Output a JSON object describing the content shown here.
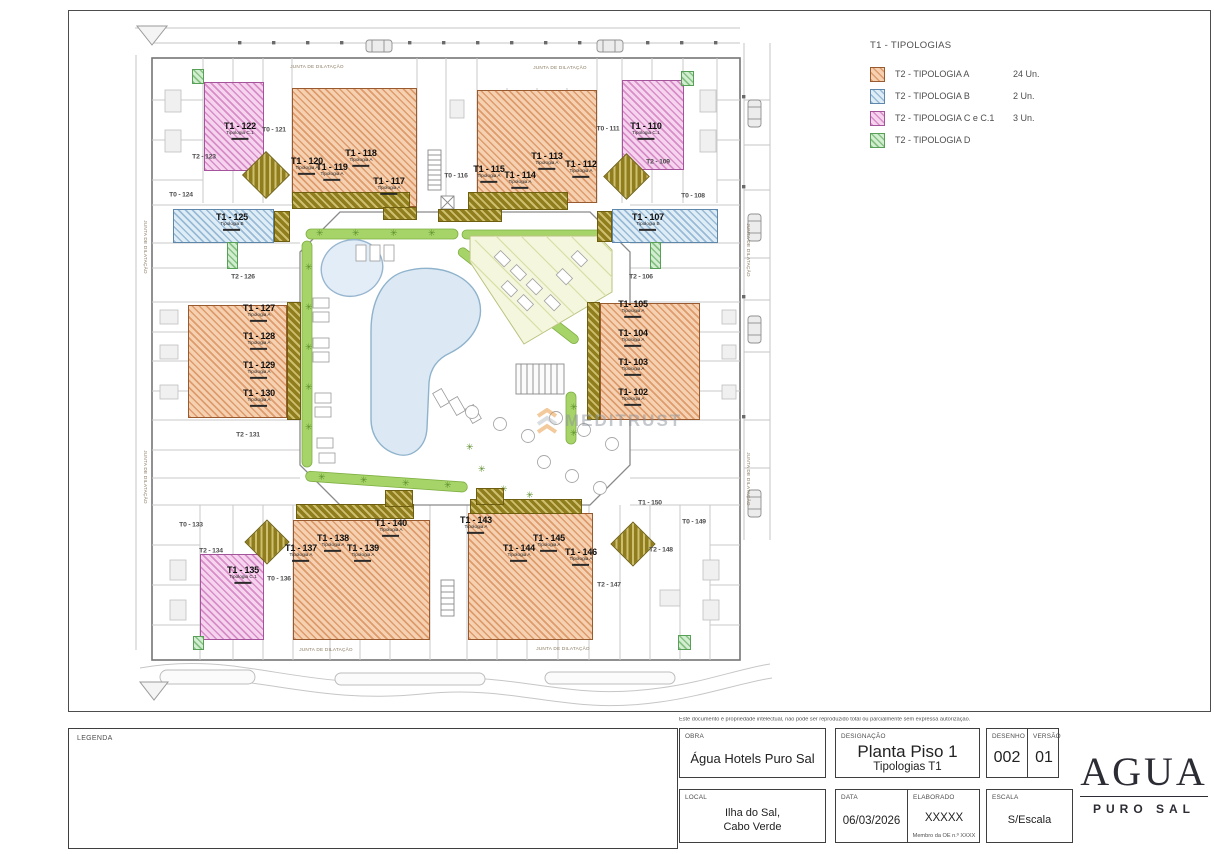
{
  "legend": {
    "title": "T1 - TIPOLOGIAS",
    "items": [
      {
        "label": "T2 - TIPOLOGIA A",
        "count": "24 Un.",
        "type": "a"
      },
      {
        "label": "T2 - TIPOLOGIA B",
        "count": "2 Un.",
        "type": "b"
      },
      {
        "label": "T2 - TIPOLOGIA C e C.1",
        "count": "3 Un.",
        "type": "c"
      },
      {
        "label": "T2 - TIPOLOGIA D",
        "count": "",
        "type": "d"
      }
    ]
  },
  "titleblock": {
    "disclaimer": "Este documento é propriedade intelectual, não pode ser reproduzido total ou parcialmente sem expressa autorização.",
    "legenda_label": "LEGENDA",
    "obra_label": "OBRA",
    "obra": "Água Hotels Puro Sal",
    "designacao_label": "DESIGNAÇÃO",
    "designacao": "Planta Piso 1",
    "designacao_sub": "Tipologias T1",
    "desenho_label": "DESENHO",
    "desenho": "002",
    "versao_label": "VERSÃO",
    "versao": "01",
    "local_label": "LOCAL",
    "local_line1": "Ilha do Sal,",
    "local_line2": "Cabo Verde",
    "data_label": "DATA",
    "data": "06/03/2026",
    "elaborado_label": "ELABORADO",
    "elaborado": "XXXXX",
    "elaborado_sub": "Membro da OE n.º XXXX",
    "escala_label": "ESCALA",
    "escala": "S/Escala"
  },
  "logo": {
    "name": "AGUA",
    "tagline": "PURO SAL"
  },
  "watermark": {
    "text": "MEDITRUST"
  },
  "plan": {
    "junta_label": "JUNTA DE DILATAÇÃO",
    "annotations": [
      {
        "x": 317,
        "y": 67,
        "v": false
      },
      {
        "x": 560,
        "y": 68,
        "v": false
      },
      {
        "x": 326,
        "y": 650,
        "v": false
      },
      {
        "x": 563,
        "y": 649,
        "v": false
      },
      {
        "x": 145,
        "y": 247,
        "v": true
      },
      {
        "x": 145,
        "y": 477,
        "v": true
      },
      {
        "x": 748,
        "y": 250,
        "v": true
      },
      {
        "x": 748,
        "y": 479,
        "v": true
      }
    ],
    "rooms": [
      {
        "label": "T1 - 122",
        "sub": "Tipologia C.1",
        "x": 240,
        "y": 131,
        "t": "c"
      },
      {
        "label": "T1 - 110",
        "sub": "Tipologia C.1",
        "x": 646,
        "y": 131,
        "t": "c"
      },
      {
        "label": "T1 - 135",
        "sub": "Tipologia C.1",
        "x": 243,
        "y": 575,
        "t": "c"
      },
      {
        "label": "T1 - 125",
        "sub": "Tipologia B",
        "x": 232,
        "y": 222,
        "t": "b"
      },
      {
        "label": "T1 - 107",
        "sub": "Tipologia B",
        "x": 648,
        "y": 222,
        "t": "b"
      },
      {
        "label": "T1 - 120",
        "sub": "Tipologia A",
        "x": 307,
        "y": 166,
        "t": "a"
      },
      {
        "label": "T1 - 119",
        "sub": "Tipologia A",
        "x": 332,
        "y": 172,
        "t": "a"
      },
      {
        "label": "T1 - 118",
        "sub": "Tipologia A",
        "x": 361,
        "y": 158,
        "t": "a"
      },
      {
        "label": "T1 - 117",
        "sub": "Tipologia A",
        "x": 389,
        "y": 186,
        "t": "a"
      },
      {
        "label": "T1 - 115",
        "sub": "Tipologia A",
        "x": 489,
        "y": 174,
        "t": "a"
      },
      {
        "label": "T1 - 114",
        "sub": "Tipologia A",
        "x": 520,
        "y": 180,
        "t": "a"
      },
      {
        "label": "T1 - 113",
        "sub": "Tipologia A",
        "x": 547,
        "y": 161,
        "t": "a"
      },
      {
        "label": "T1 - 112",
        "sub": "Tipologia A",
        "x": 581,
        "y": 169,
        "t": "a"
      },
      {
        "label": "T1 - 127",
        "sub": "Tipologia A",
        "x": 259,
        "y": 313,
        "t": "a"
      },
      {
        "label": "T1 - 128",
        "sub": "Tipologia A",
        "x": 259,
        "y": 341,
        "t": "a"
      },
      {
        "label": "T1 - 129",
        "sub": "Tipologia A",
        "x": 259,
        "y": 370,
        "t": "a"
      },
      {
        "label": "T1 - 130",
        "sub": "Tipologia A",
        "x": 259,
        "y": 398,
        "t": "a"
      },
      {
        "label": "T1- 105",
        "sub": "Tipologia A",
        "x": 633,
        "y": 309,
        "t": "a"
      },
      {
        "label": "T1- 104",
        "sub": "Tipologia A",
        "x": 633,
        "y": 338,
        "t": "a"
      },
      {
        "label": "T1- 103",
        "sub": "Tipologia A",
        "x": 633,
        "y": 367,
        "t": "a"
      },
      {
        "label": "T1- 102",
        "sub": "Tipologia A",
        "x": 633,
        "y": 397,
        "t": "a"
      },
      {
        "label": "T1 - 137",
        "sub": "Tipologia A",
        "x": 301,
        "y": 553,
        "t": "a"
      },
      {
        "label": "T1 - 138",
        "sub": "Tipologia A",
        "x": 333,
        "y": 543,
        "t": "a"
      },
      {
        "label": "T1 - 139",
        "sub": "Tipologia A",
        "x": 363,
        "y": 553,
        "t": "a"
      },
      {
        "label": "T1 - 140",
        "sub": "Tipologia A",
        "x": 391,
        "y": 528,
        "t": "a"
      },
      {
        "label": "T1 - 143",
        "sub": "Tipologia A",
        "x": 476,
        "y": 525,
        "t": "a"
      },
      {
        "label": "T1 - 144",
        "sub": "Tipologia A",
        "x": 519,
        "y": 553,
        "t": "a"
      },
      {
        "label": "T1 - 145",
        "sub": "Tipologia A",
        "x": 549,
        "y": 543,
        "t": "a"
      },
      {
        "label": "T1 - 146",
        "sub": "Tipologia A",
        "x": 581,
        "y": 557,
        "t": "a"
      },
      {
        "label": "T0 - 121",
        "x": 274,
        "y": 131
      },
      {
        "label": "T2 - 123",
        "x": 204,
        "y": 158
      },
      {
        "label": "T0 - 124",
        "x": 181,
        "y": 196
      },
      {
        "label": "T2 - 126",
        "x": 243,
        "y": 278
      },
      {
        "label": "T2 - 131",
        "x": 248,
        "y": 436
      },
      {
        "label": "T0 - 133",
        "x": 191,
        "y": 526
      },
      {
        "label": "T2 - 134",
        "x": 211,
        "y": 552
      },
      {
        "label": "T0 - 136",
        "x": 279,
        "y": 580
      },
      {
        "label": "T0 - 116",
        "x": 456,
        "y": 177
      },
      {
        "label": "T0 - 111",
        "x": 608,
        "y": 130
      },
      {
        "label": "T2 - 109",
        "x": 658,
        "y": 163
      },
      {
        "label": "T0 - 108",
        "x": 693,
        "y": 197
      },
      {
        "label": "T2 - 106",
        "x": 641,
        "y": 278
      },
      {
        "label": "T2 - 147",
        "x": 609,
        "y": 586
      },
      {
        "label": "T2 - 148",
        "x": 661,
        "y": 551
      },
      {
        "label": "T0 - 149",
        "x": 694,
        "y": 523
      },
      {
        "label": "T1 - 150",
        "x": 650,
        "y": 504
      }
    ]
  },
  "colors": {
    "typ_a": "#e79a62",
    "typ_b": "#9dc3de",
    "typ_c": "#cf79c0",
    "typ_d": "#86c979",
    "balcony": "#8f7d1e",
    "pool": "#dce9f4",
    "hedge": "#9ccf5f"
  }
}
